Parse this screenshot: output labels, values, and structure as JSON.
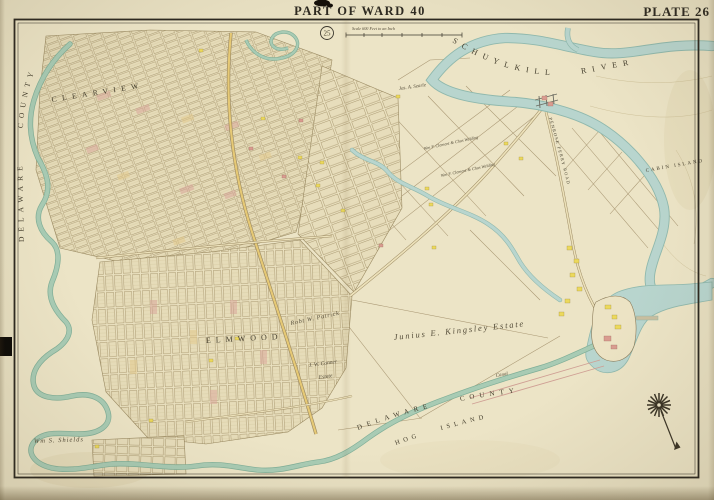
{
  "header": {
    "title": "PART OF WARD 40",
    "plate_label": "PLATE 26",
    "adjoining_plate_number": "25",
    "scale_note": "Scale 600 Feet to an Inch"
  },
  "labels": {
    "river": "SCHUYLKILL RIVER",
    "county_left": "DELAWARE COUNTY",
    "county_bottom": "DELAWARE COUNTY",
    "hog_island": "HOG ISLAND",
    "cabin_island": "CABIN ISLAND",
    "clearview": "CLEARVIEW",
    "elmwood": "ELMWOOD",
    "penrose_ferry_road": "PENROSE FERRY ROAD",
    "canal": "Canal"
  },
  "estates": {
    "kingsley": "Junius E. Kingsley Estate",
    "patrick": "Robt W. Patrick",
    "conner_line1": "J. W. Conner",
    "conner_line2": "Estate",
    "shields": "Wm S. Shields",
    "searle": "Jas. A. Searle",
    "clement_upper": "Wm F. Clement & Chas Welding",
    "clement_lower": "Wm F. Clement & Chas Welding"
  },
  "colors": {
    "paper": "#e7dfc1",
    "map_paper": "#ece4c6",
    "water_fill": "#b8d5ce",
    "water_edge": "#8fb8ad",
    "creek_fill": "#a8cbb4",
    "creek_edge": "#7fae97",
    "ink": "#3c3629",
    "block_line": "#a29066",
    "road_fill": "#e6c975",
    "building_yellow": "#ecd95c",
    "building_pink": "#d99c90"
  }
}
